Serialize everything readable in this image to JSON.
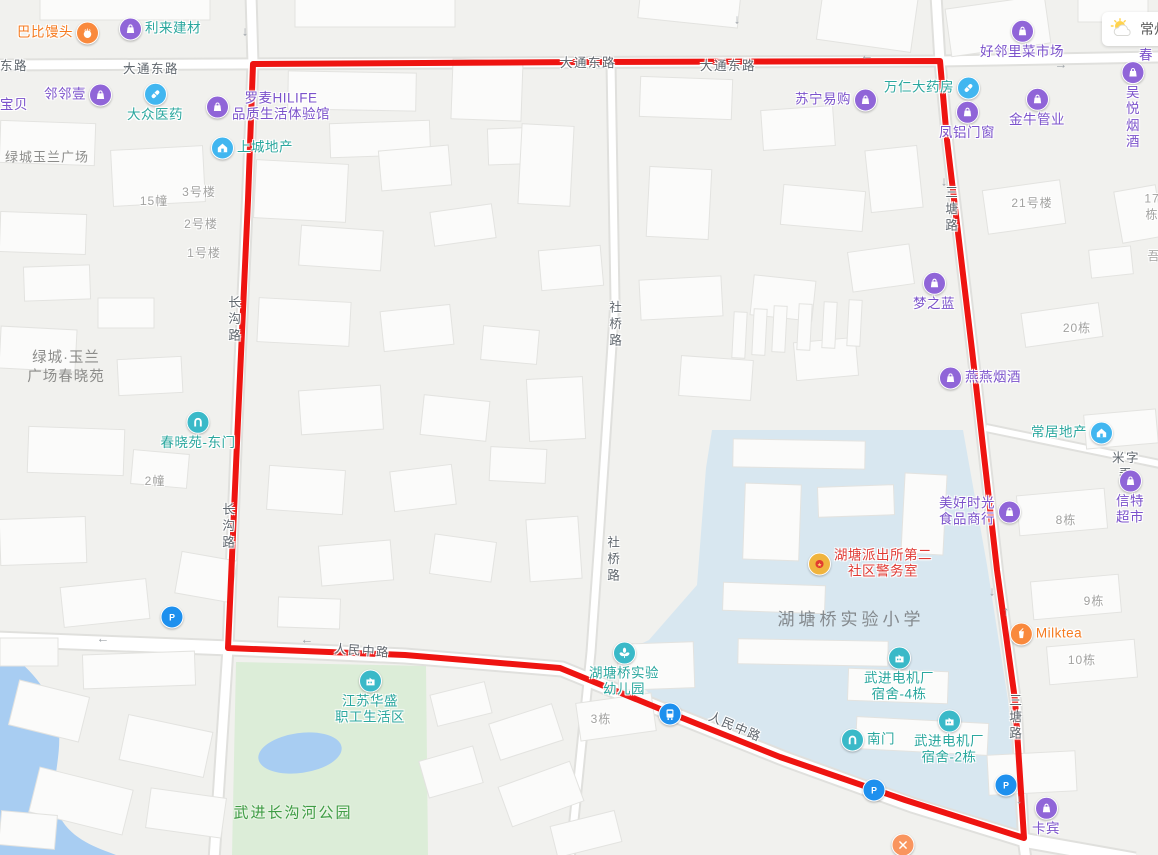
{
  "map": {
    "weather": {
      "city": "常州"
    },
    "road_labels": [
      {
        "text": "东路",
        "x": 14,
        "y": 66
      },
      {
        "text": "大通东路",
        "x": 151,
        "y": 69
      },
      {
        "text": "大通东路",
        "x": 588,
        "y": 63
      },
      {
        "text": "大通东路",
        "x": 728,
        "y": 66
      },
      {
        "text": "人民中路",
        "x": 362,
        "y": 651,
        "angle": 4
      },
      {
        "text": "人民中路",
        "x": 735,
        "y": 727,
        "angle": 23
      },
      {
        "text": "米字弄",
        "x": 1126,
        "y": 466
      },
      {
        "text": "三塘路",
        "x": 950,
        "y": 210,
        "vertical": true
      },
      {
        "text": "三塘路",
        "x": 1014,
        "y": 718,
        "vertical": true
      },
      {
        "text": "长沟路",
        "x": 233,
        "y": 320,
        "vertical": true
      },
      {
        "text": "长沟路",
        "x": 227,
        "y": 527,
        "vertical": true
      },
      {
        "text": "社桥路",
        "x": 614,
        "y": 325,
        "vertical": true
      },
      {
        "text": "社桥路",
        "x": 612,
        "y": 560,
        "vertical": true
      }
    ],
    "building_labels": [
      {
        "text": "3号楼",
        "x": 199,
        "y": 193
      },
      {
        "text": "15幢",
        "x": 154,
        "y": 202
      },
      {
        "text": "2号楼",
        "x": 201,
        "y": 225
      },
      {
        "text": "1号楼",
        "x": 204,
        "y": 254
      },
      {
        "text": "2幢",
        "x": 155,
        "y": 482
      },
      {
        "text": "21号楼",
        "x": 1032,
        "y": 204
      },
      {
        "text": "17栋",
        "x": 1152,
        "y": 207
      },
      {
        "text": "吾",
        "x": 1154,
        "y": 257
      },
      {
        "text": "20栋",
        "x": 1077,
        "y": 329
      },
      {
        "text": "8栋",
        "x": 1066,
        "y": 521
      },
      {
        "text": "9栋",
        "x": 1094,
        "y": 602
      },
      {
        "text": "10栋",
        "x": 1082,
        "y": 661
      },
      {
        "text": "3栋",
        "x": 601,
        "y": 720
      }
    ],
    "area_labels": [
      {
        "text": "绿城玉兰广场",
        "x": 47,
        "y": 158,
        "kind": "normal"
      },
      {
        "text": "绿城·玉兰\n广场春晓苑",
        "x": 66,
        "y": 368,
        "kind": "normal2"
      },
      {
        "text": "湖塘桥实验小学",
        "x": 851,
        "y": 620,
        "kind": "school"
      },
      {
        "text": "武进长沟河公园",
        "x": 293,
        "y": 813,
        "kind": "park"
      }
    ],
    "arrows": [
      {
        "glyph": "↓",
        "x": 245,
        "y": 32
      },
      {
        "glyph": "←",
        "x": 128,
        "y": 66
      },
      {
        "glyph": "↓",
        "x": 737,
        "y": 20
      },
      {
        "glyph": "←",
        "x": 867,
        "y": 56
      },
      {
        "glyph": "→",
        "x": 1061,
        "y": 65
      },
      {
        "glyph": "↓",
        "x": 944,
        "y": 182
      },
      {
        "glyph": "↓",
        "x": 992,
        "y": 592
      },
      {
        "glyph": "↑",
        "x": 1006,
        "y": 612
      },
      {
        "glyph": "↓",
        "x": 1019,
        "y": 800
      },
      {
        "glyph": "←",
        "x": 103,
        "y": 639
      },
      {
        "glyph": "←",
        "x": 307,
        "y": 640
      }
    ],
    "pois": [
      {
        "name": "babi-mantou",
        "label": "巴比馒头",
        "x": 58,
        "y": 33,
        "color": "orange",
        "icon": "food",
        "icon_pos": "right"
      },
      {
        "name": "lilai-jiancai",
        "label": "利来建材",
        "x": 160,
        "y": 29,
        "color": "teal",
        "icon": "bag",
        "icon_pos": "left"
      },
      {
        "name": "haolinli-market",
        "label": "好邻里菜市场",
        "x": 1022,
        "y": 40,
        "color": "purple",
        "icon": "bag",
        "icon_pos": "top"
      },
      {
        "name": "tingchun",
        "label": "听春",
        "x": 1146,
        "y": 48,
        "color": "purple",
        "icon": null,
        "icon_pos": "left"
      },
      {
        "name": "linlinyi",
        "label": "邻邻壹",
        "x": 78,
        "y": 95,
        "color": "purple",
        "icon": "bag",
        "icon_pos": "right"
      },
      {
        "name": "baobei",
        "label": "宝贝",
        "x": 14,
        "y": 105,
        "color": "purple",
        "icon": null,
        "icon_pos": "left"
      },
      {
        "name": "dazhong-yiyao",
        "label": "大众医药",
        "x": 155,
        "y": 103,
        "color": "teal",
        "icon": "pill",
        "icon_pos": "top"
      },
      {
        "name": "luomai-hilife",
        "label": "罗麦HILIFE\n品质生活体验馆",
        "x": 268,
        "y": 107,
        "color": "purple",
        "icon": "bag",
        "icon_pos": "left"
      },
      {
        "name": "shangcheng-dichan",
        "label": "上城地产",
        "x": 252,
        "y": 148,
        "color": "teal",
        "icon": "house",
        "icon_pos": "left"
      },
      {
        "name": "suning-yigou",
        "label": "苏宁易购",
        "x": 836,
        "y": 100,
        "color": "purple",
        "icon": "bag",
        "icon_pos": "right"
      },
      {
        "name": "wanren-dayaofang",
        "label": "万仁大药房",
        "x": 932,
        "y": 88,
        "color": "teal",
        "icon": "pill",
        "icon_pos": "right"
      },
      {
        "name": "fenglv-menchuang",
        "label": "凤铝门窗",
        "x": 967,
        "y": 121,
        "color": "purple",
        "icon": "bag",
        "icon_pos": "top"
      },
      {
        "name": "jinniu-guanye",
        "label": "金牛管业",
        "x": 1037,
        "y": 108,
        "color": "purple",
        "icon": "bag",
        "icon_pos": "top"
      },
      {
        "name": "wuyue-yanjiu",
        "label": "吴悦烟酒",
        "x": 1133,
        "y": 106,
        "color": "purple",
        "icon": "bag",
        "icon_pos": "top"
      },
      {
        "name": "mengzhilan",
        "label": "梦之蓝",
        "x": 934,
        "y": 292,
        "color": "purple",
        "icon": "bag",
        "icon_pos": "top"
      },
      {
        "name": "yanyan-yanjiu",
        "label": "燕燕烟酒",
        "x": 980,
        "y": 378,
        "color": "purple",
        "icon": "bag",
        "icon_pos": "left"
      },
      {
        "name": "changju-dichan",
        "label": "常居地产",
        "x": 1072,
        "y": 433,
        "color": "teal",
        "icon": "house",
        "icon_pos": "right"
      },
      {
        "name": "chunxiaoyuan-east-gate",
        "label": "春晓苑-东门",
        "x": 198,
        "y": 431,
        "color": "teal",
        "icon": "gate",
        "icon_pos": "top"
      },
      {
        "name": "meihao-shiguang",
        "label": "美好时光\n食品商行",
        "x": 980,
        "y": 512,
        "color": "purple",
        "icon": "bag",
        "icon_pos": "right"
      },
      {
        "name": "xinte-chaoshi",
        "label": "信特超市",
        "x": 1130,
        "y": 498,
        "color": "purple",
        "icon": "bag",
        "icon_pos": "top"
      },
      {
        "name": "hutang-police-room",
        "label": "湖塘派出所第二\n社区警务室",
        "x": 870,
        "y": 564,
        "color": "red",
        "icon": "police",
        "icon_pos": "left"
      },
      {
        "name": "milktea",
        "label": "Milktea",
        "x": 1046,
        "y": 634,
        "color": "orange",
        "icon": "cup",
        "icon_pos": "left"
      },
      {
        "name": "dianjichang-dorm-4",
        "label": "武进电机厂\n宿舍-4栋",
        "x": 899,
        "y": 675,
        "color": "teal",
        "icon": "factory",
        "icon_pos": "top"
      },
      {
        "name": "dianjichang-dorm-2",
        "label": "武进电机厂\n宿舍-2栋",
        "x": 949,
        "y": 738,
        "color": "teal",
        "icon": "factory",
        "icon_pos": "top"
      },
      {
        "name": "south-gate",
        "label": "南门",
        "x": 868,
        "y": 740,
        "color": "teal",
        "icon": "gate",
        "icon_pos": "left"
      },
      {
        "name": "hutangqiao-kindergarten",
        "label": "湖塘桥实验\n幼儿园",
        "x": 624,
        "y": 670,
        "color": "teal",
        "icon": "school",
        "icon_pos": "top"
      },
      {
        "name": "jiangsu-huasheng",
        "label": "江苏华盛\n职工生活区",
        "x": 370,
        "y": 698,
        "color": "teal",
        "icon": "factory",
        "icon_pos": "top"
      },
      {
        "name": "kabin",
        "label": "卡宾",
        "x": 1046,
        "y": 817,
        "color": "purple",
        "icon": "bag",
        "icon_pos": "top"
      },
      {
        "name": "parking-1",
        "label": "",
        "x": 172,
        "y": 617,
        "color": "blue",
        "icon": "parking",
        "icon_pos": "only"
      },
      {
        "name": "parking-2",
        "label": "",
        "x": 874,
        "y": 790,
        "color": "blue",
        "icon": "parking",
        "icon_pos": "only"
      },
      {
        "name": "parking-3",
        "label": "",
        "x": 1006,
        "y": 785,
        "color": "blue",
        "icon": "parking",
        "icon_pos": "only"
      },
      {
        "name": "bus-stop",
        "label": "",
        "x": 670,
        "y": 714,
        "color": "blue",
        "icon": "bus",
        "icon_pos": "only"
      },
      {
        "name": "restaurant",
        "label": "",
        "x": 903,
        "y": 845,
        "color": "orange",
        "icon": "fork",
        "icon_pos": "only"
      }
    ]
  },
  "colors": {
    "purple_text": "#7b52cb",
    "teal_text": "#2aa79e",
    "orange_text": "#f57a1f",
    "red_text": "#e03a34",
    "blue_text": "#1e90ee",
    "road_label": "#5f666d",
    "building_label": "#a2a2a0",
    "area_label": "#8c8c8a",
    "school_label": "#84898d",
    "park_label": "#3f9c45",
    "red_line": "#ee1411",
    "campus_fill": "#d8e7f0",
    "park_fill": "#dcedd8",
    "water_fill": "#a8cdf2"
  },
  "icon_colors": {
    "bag": "#9065d8",
    "pill": "#41b6f0",
    "house": "#41b6f0",
    "gate": "#3ab9c8",
    "school": "#3ab9c8",
    "factory": "#3ab9c8",
    "parking": "#1e90ee",
    "bus": "#1e90ee",
    "police": "#f0b43e",
    "food": "#f9893d",
    "cup": "#f9893d",
    "fork": "#f9955f"
  }
}
